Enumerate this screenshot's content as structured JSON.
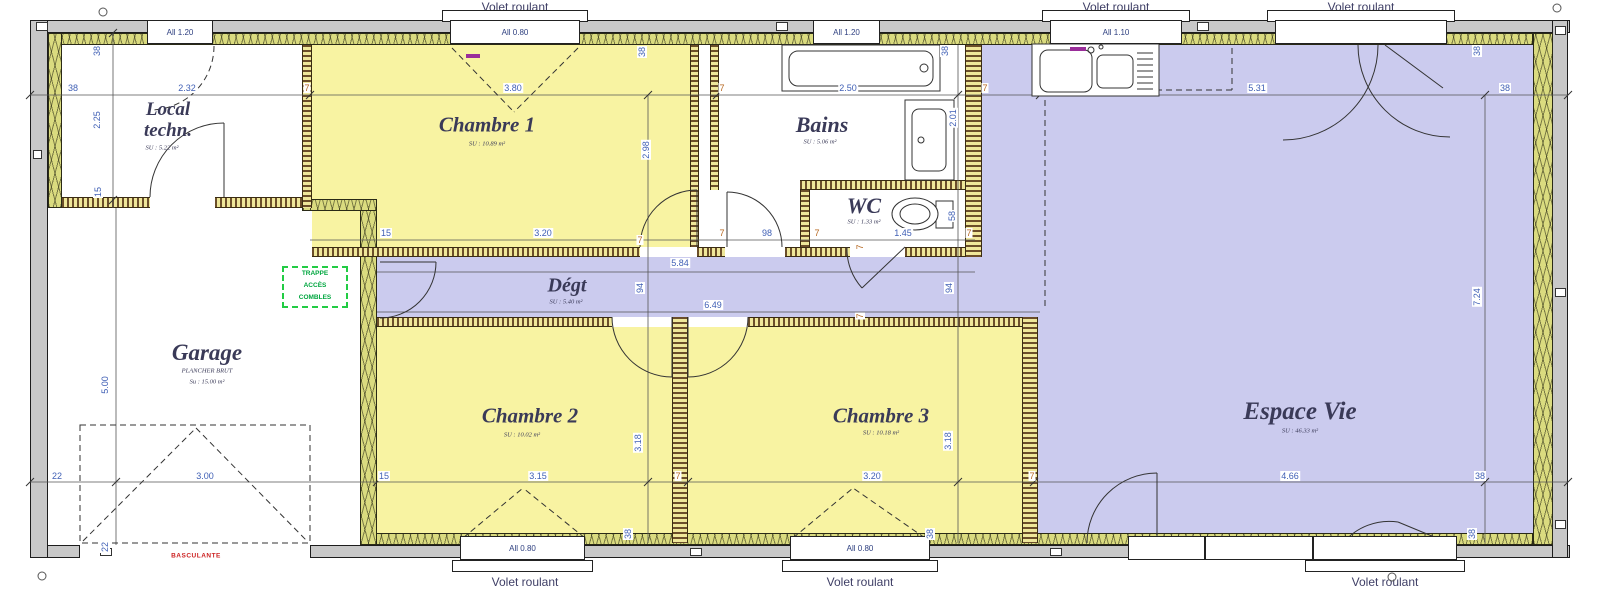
{
  "rooms": {
    "local_techn": {
      "line1": "Local",
      "line2": "techn.",
      "area": "SU : 5.22 m²"
    },
    "chambre1": {
      "name": "Chambre 1",
      "area": "SU : 10.89 m²"
    },
    "bains": {
      "name": "Bains",
      "area": "SU : 5.06 m²"
    },
    "wc": {
      "name": "WC",
      "area": "SU : 1.33 m²"
    },
    "degt": {
      "name": "Dégt",
      "area": "SU : 5.40 m²"
    },
    "chambre2": {
      "name": "Chambre 2",
      "area": "SU : 10.02 m²"
    },
    "chambre3": {
      "name": "Chambre 3",
      "area": "SU : 10.18 m²"
    },
    "espace_vie": {
      "name": "Espace Vie",
      "area": "SU : 46.33 m²"
    },
    "garage": {
      "name": "Garage",
      "sub": "PLANCHER BRUT",
      "area": "Su : 15.00 m²"
    }
  },
  "shutters": {
    "label": "Volet roulant"
  },
  "windows": [
    {
      "label": "All 1.20"
    },
    {
      "label": "All 0.80"
    },
    {
      "label": "All 1.20"
    },
    {
      "label": "All 1.10"
    },
    {
      "label": "All 0.80"
    },
    {
      "label": "All 0.80"
    }
  ],
  "dims": {
    "top": [
      "38",
      "2.32",
      "7",
      "3.80",
      "7",
      "2.50",
      "7",
      "5.31",
      "38"
    ],
    "top_v": [
      "38",
      "2.25",
      "15",
      "38",
      "2.98",
      "38",
      "2.01",
      "38"
    ],
    "mid": [
      "15",
      "3.20",
      "7",
      "7",
      "98",
      "7",
      "1.45",
      "7",
      "58"
    ],
    "degt": [
      "5.84",
      "6.49",
      "94",
      "94",
      "7",
      "7"
    ],
    "bottom": [
      "22",
      "3.00",
      "15",
      "3.15",
      "7",
      "3.20",
      "7",
      "4.66",
      "38"
    ],
    "bottom_v": [
      "5.00",
      "3.18",
      "3.18",
      "7.24",
      "22",
      "38",
      "38",
      "38"
    ]
  },
  "annotations": {
    "trappe_line1": "TRAPPE",
    "trappe_line2": "ACCÈS",
    "trappe_line3": "COMBLES",
    "garage_door_type": "BASCULANTE"
  },
  "colors": {
    "bedroom_fill": "#f8f3a2",
    "living_fill": "#cbcbee",
    "insulation_fill": "#dadb7f",
    "wall_fill": "#c8c8c8",
    "dimension_text": "#3f5fb5",
    "wall_dim_text": "#b5651d",
    "room_label": "#3a3a58",
    "trappe_green": "#00a63f",
    "garage_door_red": "#cc2222",
    "window_code_purple": "#9a2d9a"
  }
}
